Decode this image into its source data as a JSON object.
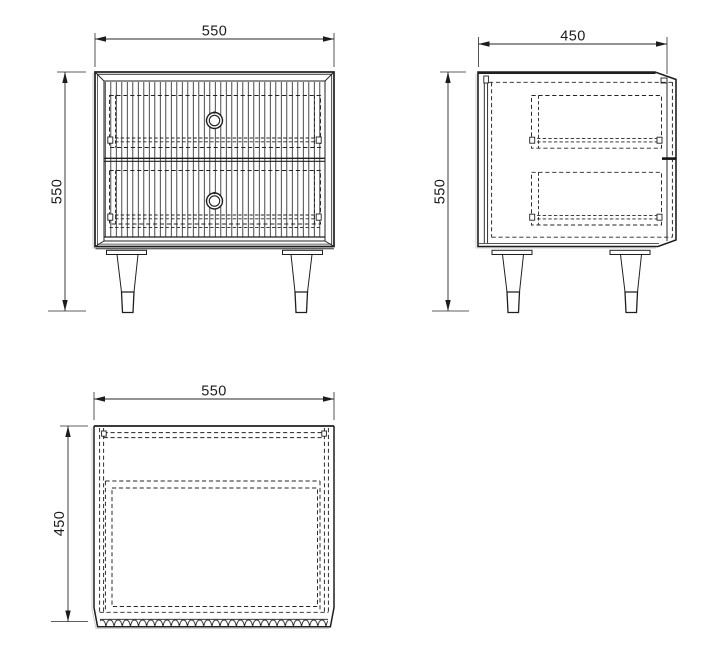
{
  "drawing": {
    "views": {
      "front": {
        "width_label": "550",
        "height_label": "550"
      },
      "side": {
        "depth_label": "450",
        "height_label": "550"
      },
      "top": {
        "width_label": "550",
        "depth_label": "450"
      }
    },
    "colors": {
      "background": "#ffffff",
      "line": "#1f1f1f"
    }
  }
}
